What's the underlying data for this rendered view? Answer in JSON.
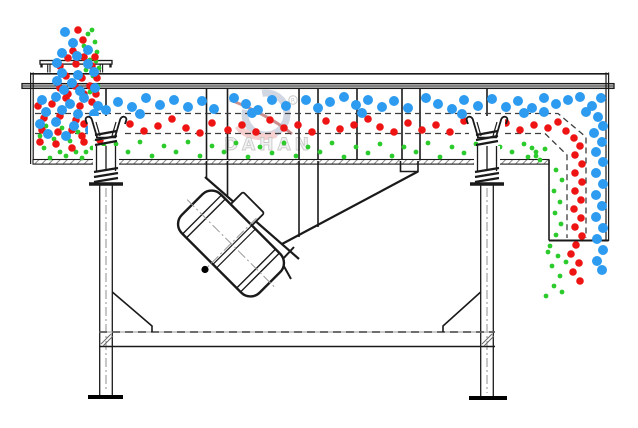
{
  "diagram": {
    "type": "linear-vibrating-screen-working-principle-schematic",
    "background": "#ffffff",
    "line_color": "#1a1a1a",
    "watermark": {
      "brand": "DAHAN",
      "registered": "R"
    },
    "particles": {
      "groups": {
        "small": {
          "label": "small-particles",
          "color": "#2bcb2b",
          "radius": 2.4,
          "points": [
            [
              92,
              30
            ],
            [
              95,
              42
            ],
            [
              88,
              34
            ],
            [
              97,
              52
            ],
            [
              90,
              60
            ],
            [
              99,
              68
            ],
            [
              93,
              76
            ],
            [
              86,
              70
            ],
            [
              98,
              86
            ],
            [
              90,
              92
            ],
            [
              84,
              46
            ],
            [
              96,
              61
            ],
            [
              46,
              126
            ],
            [
              62,
              128
            ],
            [
              78,
              132
            ],
            [
              94,
              138
            ],
            [
              44,
              148
            ],
            [
              60,
              152
            ],
            [
              76,
              152
            ],
            [
              92,
              148
            ],
            [
              50,
              158
            ],
            [
              66,
              156
            ],
            [
              82,
              158
            ],
            [
              98,
              156
            ],
            [
              40,
              136
            ],
            [
              54,
              139
            ],
            [
              70,
              141
            ],
            [
              86,
              152
            ],
            [
              104,
              146
            ],
            [
              110,
              156
            ],
            [
              116,
              144
            ],
            [
              128,
              152
            ],
            [
              140,
              142
            ],
            [
              152,
              156
            ],
            [
              164,
              146
            ],
            [
              176,
              152
            ],
            [
              188,
              142
            ],
            [
              200,
              156
            ],
            [
              212,
              146
            ],
            [
              224,
              152
            ],
            [
              236,
              143
            ],
            [
              248,
              157
            ],
            [
              260,
              147
            ],
            [
              272,
              153
            ],
            [
              284,
              143
            ],
            [
              296,
              156
            ],
            [
              308,
              147
            ],
            [
              320,
              152
            ],
            [
              332,
              143
            ],
            [
              344,
              157
            ],
            [
              356,
              147
            ],
            [
              368,
              153
            ],
            [
              380,
              144
            ],
            [
              392,
              156
            ],
            [
              404,
              147
            ],
            [
              416,
              152
            ],
            [
              428,
              143
            ],
            [
              440,
              157
            ],
            [
              452,
              147
            ],
            [
              464,
              153
            ],
            [
              476,
              144
            ],
            [
              488,
              156
            ],
            [
              500,
              147
            ],
            [
              512,
              152
            ],
            [
              524,
              144
            ],
            [
              536,
              156
            ],
            [
              545,
              149
            ],
            [
              532,
              148
            ],
            [
              556,
              170
            ],
            [
              562,
              180
            ],
            [
              554,
              191
            ],
            [
              560,
              202
            ],
            [
              555,
              213
            ],
            [
              561,
              224
            ],
            [
              556,
              235
            ],
            [
              550,
              246
            ],
            [
              558,
              256
            ],
            [
              552,
              266
            ],
            [
              560,
              276
            ],
            [
              554,
              286
            ],
            [
              562,
              292
            ],
            [
              548,
              252
            ],
            [
              566,
              262
            ],
            [
              546,
              296
            ],
            [
              540,
              160
            ],
            [
              536,
              152
            ],
            [
              528,
              157
            ]
          ]
        },
        "medium": {
          "label": "medium-particles",
          "color": "#ee1414",
          "radius": 3.8,
          "points": [
            [
              78,
              30
            ],
            [
              83,
              40
            ],
            [
              73,
              51
            ],
            [
              95,
              57
            ],
            [
              68,
              58
            ],
            [
              84,
              57
            ],
            [
              60,
              66
            ],
            [
              76,
              64
            ],
            [
              92,
              66
            ],
            [
              66,
              76
            ],
            [
              82,
              78
            ],
            [
              97,
              78
            ],
            [
              60,
              88
            ],
            [
              75,
              86
            ],
            [
              90,
              86
            ],
            [
              68,
              94
            ],
            [
              84,
              94
            ],
            [
              38,
              106
            ],
            [
              52,
              104
            ],
            [
              66,
              98
            ],
            [
              80,
              106
            ],
            [
              92,
              102
            ],
            [
              44,
              118
            ],
            [
              60,
              116
            ],
            [
              76,
              120
            ],
            [
              84,
              124
            ],
            [
              42,
              130
            ],
            [
              58,
              132
            ],
            [
              72,
              130
            ],
            [
              82,
              136
            ],
            [
              100,
              140
            ],
            [
              40,
              142
            ],
            [
              56,
              144
            ],
            [
              72,
              148
            ],
            [
              84,
              142
            ],
            [
              96,
              94
            ],
            [
              116,
              130
            ],
            [
              130,
              124
            ],
            [
              144,
              131
            ],
            [
              158,
              126
            ],
            [
              172,
              119
            ],
            [
              186,
              128
            ],
            [
              200,
              133
            ],
            [
              212,
              123
            ],
            [
              228,
              130
            ],
            [
              242,
              125
            ],
            [
              256,
              132
            ],
            [
              270,
              120
            ],
            [
              284,
              128
            ],
            [
              298,
              125
            ],
            [
              312,
              132
            ],
            [
              326,
              121
            ],
            [
              340,
              129
            ],
            [
              354,
              125
            ],
            [
              368,
              119
            ],
            [
              380,
              127
            ],
            [
              394,
              132
            ],
            [
              408,
              123
            ],
            [
              422,
              130
            ],
            [
              436,
              125
            ],
            [
              450,
              132
            ],
            [
              464,
              121
            ],
            [
              478,
              128
            ],
            [
              492,
              133
            ],
            [
              506,
              123
            ],
            [
              520,
              130
            ],
            [
              534,
              125
            ],
            [
              548,
              128
            ],
            [
              558,
              122
            ],
            [
              566,
              131
            ],
            [
              574,
              138
            ],
            [
              580,
              146
            ],
            [
              575,
              155
            ],
            [
              582,
              164
            ],
            [
              575,
              173
            ],
            [
              582,
              182
            ],
            [
              575,
              191
            ],
            [
              581,
              200
            ],
            [
              574,
              209
            ],
            [
              581,
              218
            ],
            [
              575,
              227
            ],
            [
              582,
              236
            ],
            [
              576,
              245
            ],
            [
              571,
              254
            ],
            [
              579,
              263
            ],
            [
              573,
              272
            ],
            [
              580,
              281
            ]
          ]
        },
        "large": {
          "label": "large-particles",
          "color": "#2d9bf0",
          "radius": 5,
          "points": [
            [
              65,
              32
            ],
            [
              73,
              43
            ],
            [
              62,
              53
            ],
            [
              88,
              50
            ],
            [
              77,
              56
            ],
            [
              57,
              63
            ],
            [
              88,
              64
            ],
            [
              62,
              73
            ],
            [
              78,
              75
            ],
            [
              94,
              72
            ],
            [
              57,
              81
            ],
            [
              72,
              83
            ],
            [
              95,
              88
            ],
            [
              64,
              90
            ],
            [
              80,
              91
            ],
            [
              42,
              100
            ],
            [
              56,
              97
            ],
            [
              70,
              104
            ],
            [
              84,
              98
            ],
            [
              98,
              106
            ],
            [
              46,
              112
            ],
            [
              62,
              110
            ],
            [
              78,
              114
            ],
            [
              94,
              114
            ],
            [
              40,
              124
            ],
            [
              56,
              122
            ],
            [
              74,
              126
            ],
            [
              90,
              130
            ],
            [
              48,
              134
            ],
            [
              66,
              136
            ],
            [
              106,
              110
            ],
            [
              118,
              102
            ],
            [
              132,
              107
            ],
            [
              146,
              98
            ],
            [
              160,
              105
            ],
            [
              174,
              100
            ],
            [
              188,
              107
            ],
            [
              202,
              101
            ],
            [
              214,
              109
            ],
            [
              234,
              98
            ],
            [
              246,
              104
            ],
            [
              258,
              110
            ],
            [
              272,
              100
            ],
            [
              286,
              106
            ],
            [
              306,
              100
            ],
            [
              318,
              108
            ],
            [
              330,
              102
            ],
            [
              344,
              97
            ],
            [
              356,
              105
            ],
            [
              368,
              100
            ],
            [
              382,
              107
            ],
            [
              394,
              101
            ],
            [
              408,
              108
            ],
            [
              426,
              98
            ],
            [
              438,
              104
            ],
            [
              452,
              109
            ],
            [
              464,
              100
            ],
            [
              478,
              106
            ],
            [
              492,
              99
            ],
            [
              506,
              107
            ],
            [
              518,
              101
            ],
            [
              532,
              108
            ],
            [
              544,
              98
            ],
            [
              556,
              104
            ],
            [
              568,
              100
            ],
            [
              580,
              97
            ],
            [
              592,
              106
            ],
            [
              601,
              98
            ],
            [
              140,
              114
            ],
            [
              252,
              113
            ],
            [
              362,
              113
            ],
            [
              462,
              114
            ],
            [
              524,
              113
            ],
            [
              586,
              112
            ],
            [
              544,
              112
            ],
            [
              598,
              117
            ],
            [
              603,
              126
            ],
            [
              594,
              133
            ],
            [
              602,
              142
            ],
            [
              596,
              152
            ],
            [
              603,
              162
            ],
            [
              596,
              173
            ],
            [
              603,
              184
            ],
            [
              596,
              195
            ],
            [
              602,
              206
            ],
            [
              596,
              217
            ],
            [
              603,
              228
            ],
            [
              597,
              239
            ],
            [
              603,
              250
            ],
            [
              597,
              261
            ],
            [
              602,
              270
            ]
          ]
        }
      }
    }
  }
}
